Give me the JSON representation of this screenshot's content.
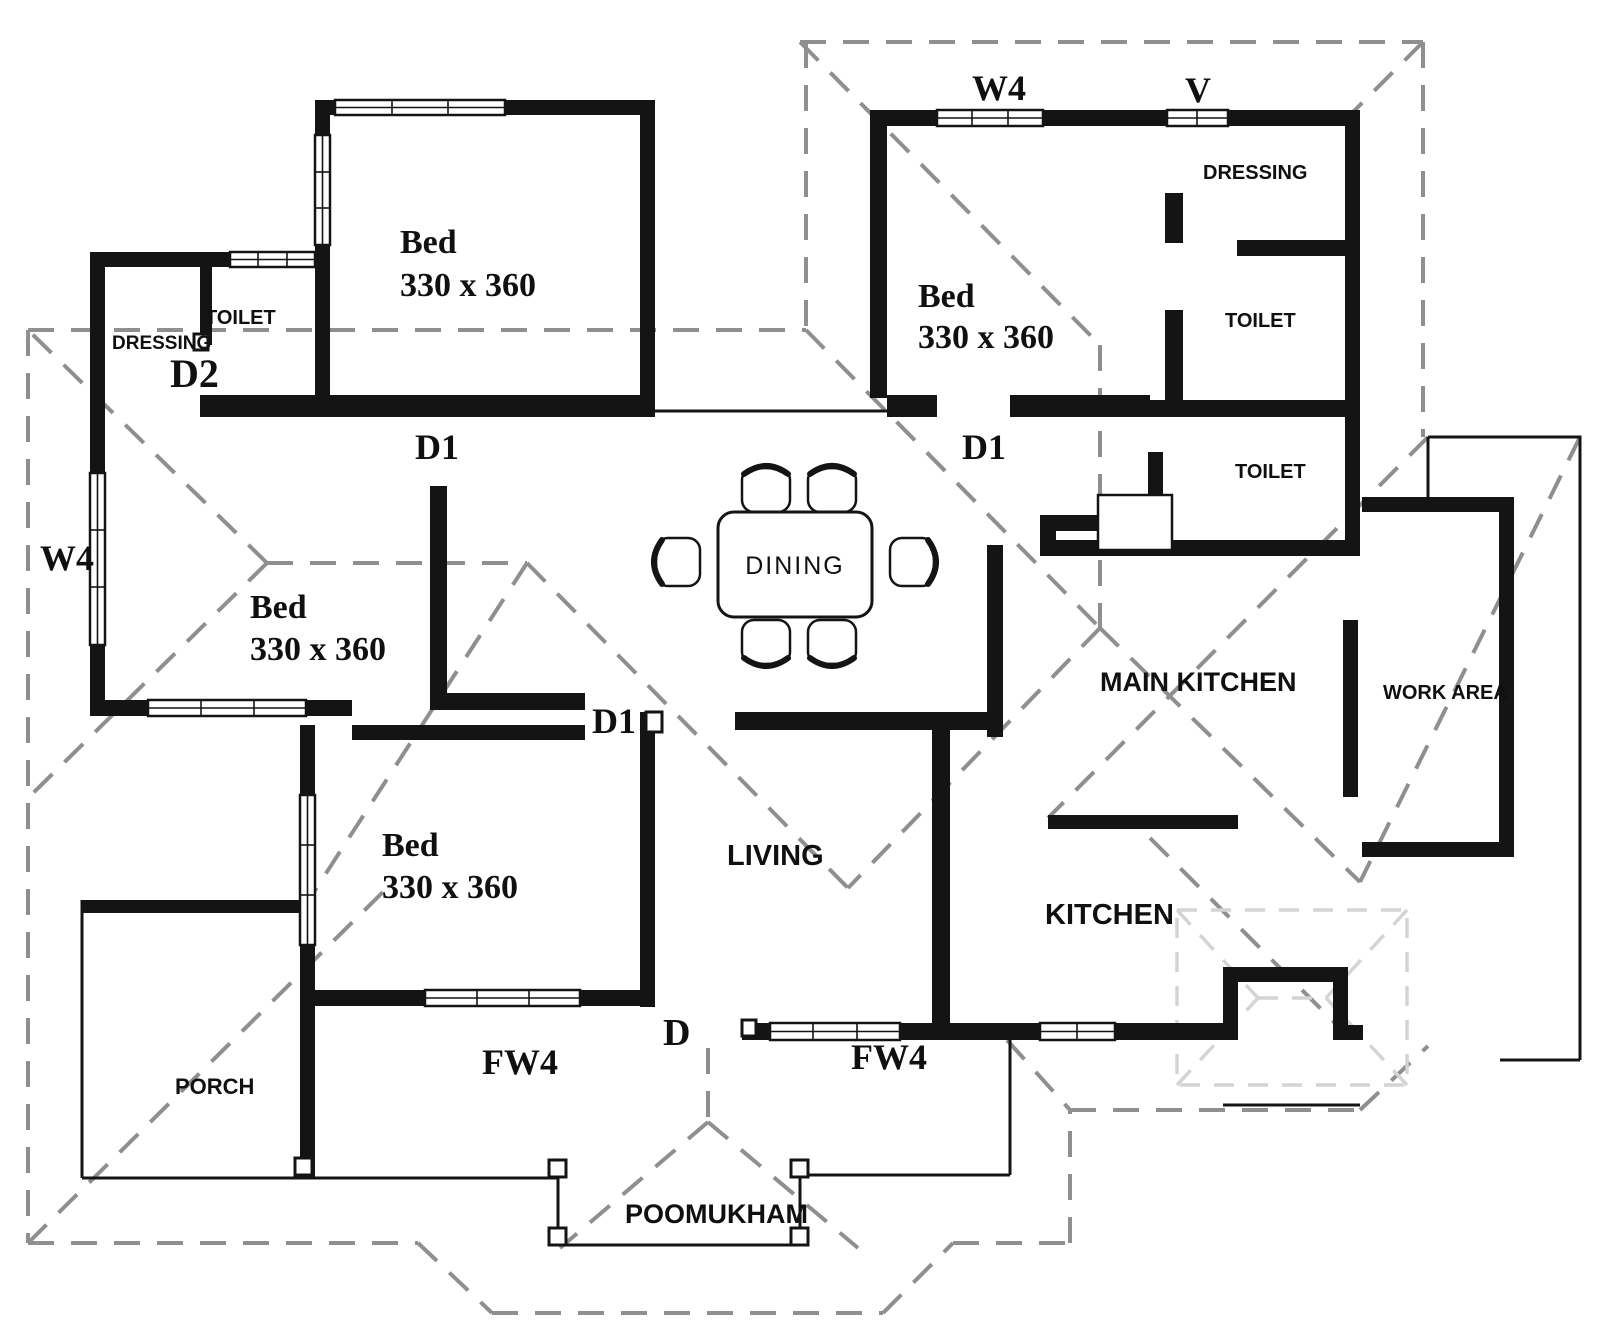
{
  "diagram": {
    "type": "floor-plan",
    "description": "Single-storey house floor plan with dashed hip-roof overlay (Kerala style)",
    "rooms": [
      {
        "name": "Bed",
        "size": "330 x 360",
        "position": "top-left"
      },
      {
        "name": "Bed",
        "size": "330 x 360",
        "position": "top-right"
      },
      {
        "name": "Bed",
        "size": "330 x 360",
        "position": "mid-left"
      },
      {
        "name": "Bed",
        "size": "330 x 360",
        "position": "bottom-center-left"
      },
      {
        "name": "TOILET",
        "position": "top-left"
      },
      {
        "name": "DRESSING",
        "position": "top-left"
      },
      {
        "name": "DRESSING",
        "position": "top-right"
      },
      {
        "name": "TOILET",
        "position": "top-right"
      },
      {
        "name": "TOILET",
        "position": "mid-right"
      },
      {
        "name": "DINING",
        "position": "center"
      },
      {
        "name": "LIVING",
        "position": "bottom-center"
      },
      {
        "name": "MAIN KITCHEN",
        "position": "right"
      },
      {
        "name": "KITCHEN",
        "position": "bottom-right"
      },
      {
        "name": "WORK AREA",
        "position": "far-right"
      },
      {
        "name": "PORCH",
        "position": "bottom-left"
      },
      {
        "name": "POOMUKHAM",
        "position": "bottom-center"
      }
    ],
    "opening_codes": [
      "W4",
      "V",
      "D",
      "D1",
      "D2",
      "FW4"
    ]
  },
  "text": {
    "bed1_name": "Bed",
    "bed1_size": "330 x 360",
    "bed2_name": "Bed",
    "bed2_size": "330 x 360",
    "bed3_name": "Bed",
    "bed3_size": "330 x 360",
    "bed4_name": "Bed",
    "bed4_size": "330 x 360",
    "toilet_tl": "TOILET",
    "dressing_tl": "DRESSING",
    "dressing_tr": "DRESSING",
    "toilet_tr": "TOILET",
    "toilet_mr": "TOILET",
    "dining": "DINING",
    "living": "LIVING",
    "main_kitchen": "MAIN KITCHEN",
    "kitchen": "KITCHEN",
    "work_area": "WORK AREA",
    "porch": "PORCH",
    "poomukham": "POOMUKHAM",
    "w4_top": "W4",
    "v_top": "V",
    "w4_left": "W4",
    "d2": "D2",
    "d1_left": "D1",
    "d1_right": "D1",
    "d1_mid": "D1",
    "d": "D",
    "fw4_left": "FW4",
    "fw4_right": "FW4"
  },
  "colors": {
    "background": "#ffffff",
    "walls": "#141414",
    "roof_dashes": "#8f8f8f",
    "roof_dashes_light": "#d4d4d4",
    "text": "#101010"
  }
}
